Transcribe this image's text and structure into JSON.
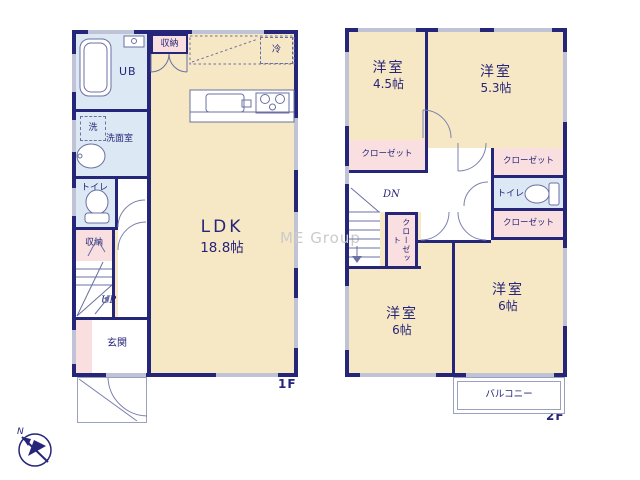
{
  "watermark": "ME Group",
  "compass": {
    "north": "N"
  },
  "floor1": {
    "label": "1F",
    "ldk_name": "LDK",
    "ldk_size": "18.8帖",
    "unit_bath": "UB",
    "washer": "洗",
    "washroom": "洗面室",
    "toilet": "トイレ",
    "storage_top": "収納",
    "storage_stairs": "収納",
    "fridge": "冷",
    "stairs": "UP",
    "entrance": "玄関"
  },
  "floor2": {
    "label": "2F",
    "room45_name": "洋室",
    "room45_size": "4.5帖",
    "room53_name": "洋室",
    "room53_size": "5.3帖",
    "room6a_name": "洋室",
    "room6a_size": "6帖",
    "room6b_name": "洋室",
    "room6b_size": "6帖",
    "closet_45": "クローゼット",
    "closet_53": "クローゼット",
    "closet_hall": "クローゼット",
    "closet_6b": "クローゼット",
    "toilet": "トイレ",
    "stairs": "DN",
    "balcony": "バルコニー"
  },
  "colors": {
    "wall": "#252579",
    "room_fill": "#f7e8c5",
    "closet_fill": "#f9dfdf",
    "wet_fill": "#dce8f4",
    "window": "#c0c3d6",
    "watermark": "#cbcbcb"
  }
}
